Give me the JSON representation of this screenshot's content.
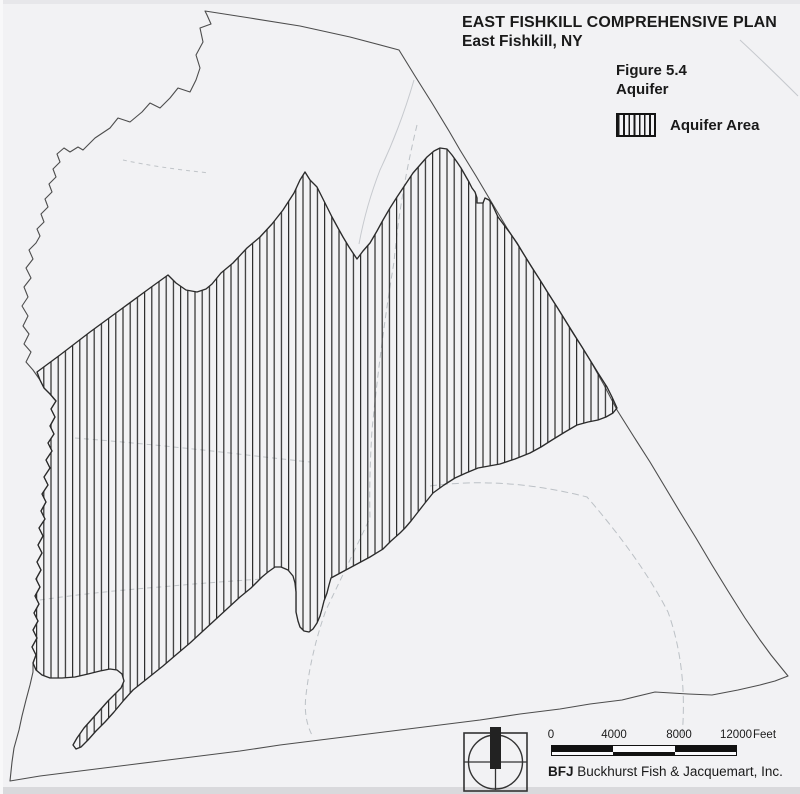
{
  "header": {
    "title": "EAST FISHKILL COMPREHENSIVE PLAN",
    "subtitle": "East Fishkill, NY",
    "figure_label": "Figure 5.4",
    "figure_title": "Aquifer"
  },
  "legend": {
    "items": [
      {
        "label": "Aquifer Area",
        "swatch": "vertical-hatch"
      }
    ]
  },
  "scale_bar": {
    "tick_labels": [
      "0",
      "4000",
      "8000",
      "12000"
    ],
    "unit_label": "Feet"
  },
  "attribution": {
    "firm_abbreviation": "BFJ",
    "firm_name": "Buckhurst Fish & Jacquemart, Inc."
  },
  "icons": {
    "north_indicator": "compass-north-arrow"
  },
  "colors": {
    "paper": "#f2f2f4",
    "ink": "#1a1a1a",
    "boundary_line": "#4d4d4d",
    "aquifer_outline": "#2b2b2b",
    "hatch_line": "#2b2b2b",
    "pencil_line": "#b3b8bd"
  },
  "map": {
    "hatch_spacing_px": 7.2,
    "town_boundary_points": [
      [
        205,
        11
      ],
      [
        250,
        18
      ],
      [
        300,
        26
      ],
      [
        350,
        37
      ],
      [
        399,
        50
      ],
      [
        415,
        76
      ],
      [
        432,
        103
      ],
      [
        449,
        131
      ],
      [
        460,
        150
      ],
      [
        476,
        176
      ],
      [
        492,
        203
      ],
      [
        507,
        228
      ],
      [
        523,
        253
      ],
      [
        540,
        280
      ],
      [
        557,
        307
      ],
      [
        574,
        334
      ],
      [
        590,
        360
      ],
      [
        604,
        385
      ],
      [
        617,
        410
      ],
      [
        634,
        437
      ],
      [
        650,
        462
      ],
      [
        665,
        487
      ],
      [
        680,
        512
      ],
      [
        696,
        538
      ],
      [
        712,
        565
      ],
      [
        728,
        591
      ],
      [
        745,
        618
      ],
      [
        760,
        640
      ],
      [
        771,
        655
      ],
      [
        788,
        676
      ],
      [
        775,
        681
      ],
      [
        760,
        685
      ],
      [
        738,
        690
      ],
      [
        712,
        695
      ],
      [
        688,
        694
      ],
      [
        655,
        692
      ],
      [
        622,
        700
      ],
      [
        590,
        704
      ],
      [
        560,
        709
      ],
      [
        520,
        714
      ],
      [
        480,
        720
      ],
      [
        440,
        725
      ],
      [
        400,
        730
      ],
      [
        360,
        735
      ],
      [
        320,
        740
      ],
      [
        280,
        745
      ],
      [
        240,
        751
      ],
      [
        200,
        756
      ],
      [
        160,
        761
      ],
      [
        120,
        766
      ],
      [
        80,
        771
      ],
      [
        40,
        776
      ],
      [
        10,
        781
      ],
      [
        12,
        762
      ],
      [
        14,
        748
      ],
      [
        19,
        730
      ],
      [
        22,
        716
      ],
      [
        26,
        700
      ],
      [
        30,
        685
      ],
      [
        33,
        672
      ],
      [
        33,
        663
      ],
      [
        36,
        655
      ],
      [
        32,
        647
      ],
      [
        37,
        638
      ],
      [
        33,
        630
      ],
      [
        38,
        621
      ],
      [
        34,
        613
      ],
      [
        39,
        604
      ],
      [
        35,
        596
      ],
      [
        40,
        587
      ],
      [
        36,
        579
      ],
      [
        41,
        570
      ],
      [
        37,
        562
      ],
      [
        42,
        553
      ],
      [
        38,
        545
      ],
      [
        43,
        536
      ],
      [
        39,
        528
      ],
      [
        45,
        519
      ],
      [
        41,
        511
      ],
      [
        46,
        502
      ],
      [
        42,
        494
      ],
      [
        48,
        485
      ],
      [
        44,
        477
      ],
      [
        50,
        468
      ],
      [
        46,
        460
      ],
      [
        52,
        451
      ],
      [
        48,
        443
      ],
      [
        54,
        434
      ],
      [
        50,
        426
      ],
      [
        55,
        417
      ],
      [
        51,
        409
      ],
      [
        56,
        401
      ],
      [
        50,
        394
      ],
      [
        44,
        388
      ],
      [
        40,
        380
      ],
      [
        33,
        370
      ],
      [
        26,
        362
      ],
      [
        31,
        352
      ],
      [
        24,
        344
      ],
      [
        29,
        334
      ],
      [
        23,
        326
      ],
      [
        28,
        316
      ],
      [
        22,
        306
      ],
      [
        28,
        297
      ],
      [
        24,
        287
      ],
      [
        31,
        278
      ],
      [
        26,
        268
      ],
      [
        33,
        259
      ],
      [
        29,
        250
      ],
      [
        36,
        243
      ],
      [
        40,
        236
      ],
      [
        37,
        229
      ],
      [
        44,
        222
      ],
      [
        41,
        214
      ],
      [
        48,
        207
      ],
      [
        45,
        199
      ],
      [
        52,
        192
      ],
      [
        49,
        184
      ],
      [
        56,
        177
      ],
      [
        53,
        169
      ],
      [
        60,
        162
      ],
      [
        57,
        154
      ],
      [
        64,
        148
      ],
      [
        70,
        152
      ],
      [
        78,
        147
      ],
      [
        83,
        150
      ],
      [
        95,
        138
      ],
      [
        110,
        128
      ],
      [
        118,
        118
      ],
      [
        130,
        122
      ],
      [
        142,
        112
      ],
      [
        150,
        103
      ],
      [
        160,
        108
      ],
      [
        170,
        98
      ],
      [
        178,
        88
      ],
      [
        190,
        92
      ],
      [
        196,
        80
      ],
      [
        200,
        68
      ],
      [
        196,
        55
      ],
      [
        203,
        42
      ],
      [
        200,
        28
      ],
      [
        211,
        24
      ],
      [
        207,
        15
      ]
    ],
    "aquifer_area_points": [
      [
        37,
        372
      ],
      [
        60,
        355
      ],
      [
        90,
        332
      ],
      [
        120,
        310
      ],
      [
        150,
        288
      ],
      [
        168,
        275
      ],
      [
        176,
        283
      ],
      [
        186,
        290
      ],
      [
        197,
        292
      ],
      [
        206,
        289
      ],
      [
        212,
        284
      ],
      [
        221,
        273
      ],
      [
        233,
        263
      ],
      [
        247,
        248
      ],
      [
        260,
        237
      ],
      [
        272,
        224
      ],
      [
        283,
        210
      ],
      [
        294,
        193
      ],
      [
        300,
        180
      ],
      [
        305,
        172
      ],
      [
        310,
        180
      ],
      [
        317,
        187
      ],
      [
        325,
        203
      ],
      [
        332,
        217
      ],
      [
        338,
        228
      ],
      [
        343,
        237
      ],
      [
        349,
        247
      ],
      [
        353,
        253
      ],
      [
        357,
        259
      ],
      [
        363,
        251
      ],
      [
        370,
        243
      ],
      [
        377,
        231
      ],
      [
        383,
        220
      ],
      [
        390,
        208
      ],
      [
        397,
        197
      ],
      [
        405,
        185
      ],
      [
        413,
        173
      ],
      [
        420,
        165
      ],
      [
        427,
        157
      ],
      [
        434,
        151
      ],
      [
        440,
        148
      ],
      [
        447,
        149
      ],
      [
        452,
        155
      ],
      [
        457,
        162
      ],
      [
        461,
        168
      ],
      [
        465,
        175
      ],
      [
        469,
        182
      ],
      [
        472,
        188
      ],
      [
        475,
        192
      ],
      [
        477,
        198
      ],
      [
        477,
        203
      ],
      [
        483,
        203
      ],
      [
        485,
        198
      ],
      [
        489,
        200
      ],
      [
        492,
        204
      ],
      [
        498,
        217
      ],
      [
        504,
        225
      ],
      [
        510,
        233
      ],
      [
        517,
        243
      ],
      [
        523,
        253
      ],
      [
        531,
        266
      ],
      [
        540,
        280
      ],
      [
        548,
        293
      ],
      [
        557,
        307
      ],
      [
        565,
        320
      ],
      [
        573,
        333
      ],
      [
        582,
        347
      ],
      [
        590,
        360
      ],
      [
        598,
        373
      ],
      [
        607,
        387
      ],
      [
        612,
        397
      ],
      [
        617,
        408
      ],
      [
        613,
        413
      ],
      [
        606,
        417
      ],
      [
        598,
        420
      ],
      [
        588,
        422
      ],
      [
        577,
        425
      ],
      [
        565,
        432
      ],
      [
        552,
        440
      ],
      [
        541,
        447
      ],
      [
        530,
        453
      ],
      [
        515,
        459
      ],
      [
        500,
        464
      ],
      [
        489,
        466
      ],
      [
        478,
        468
      ],
      [
        466,
        473
      ],
      [
        455,
        478
      ],
      [
        444,
        485
      ],
      [
        433,
        493
      ],
      [
        425,
        503
      ],
      [
        418,
        512
      ],
      [
        411,
        521
      ],
      [
        405,
        528
      ],
      [
        400,
        533
      ],
      [
        391,
        541
      ],
      [
        383,
        549
      ],
      [
        370,
        557
      ],
      [
        357,
        564
      ],
      [
        344,
        571
      ],
      [
        331,
        578
      ],
      [
        329,
        585
      ],
      [
        327,
        593
      ],
      [
        324,
        601
      ],
      [
        322,
        609
      ],
      [
        320,
        616
      ],
      [
        317,
        623
      ],
      [
        313,
        629
      ],
      [
        309,
        632
      ],
      [
        304,
        631
      ],
      [
        300,
        627
      ],
      [
        298,
        621
      ],
      [
        296,
        612
      ],
      [
        296,
        601
      ],
      [
        296,
        592
      ],
      [
        295,
        583
      ],
      [
        293,
        576
      ],
      [
        288,
        570
      ],
      [
        281,
        567
      ],
      [
        275,
        567
      ],
      [
        268,
        572
      ],
      [
        262,
        577
      ],
      [
        251,
        588
      ],
      [
        240,
        597
      ],
      [
        228,
        608
      ],
      [
        215,
        620
      ],
      [
        203,
        631
      ],
      [
        190,
        643
      ],
      [
        177,
        654
      ],
      [
        163,
        666
      ],
      [
        148,
        678
      ],
      [
        133,
        690
      ],
      [
        124,
        700
      ],
      [
        114,
        712
      ],
      [
        105,
        722
      ],
      [
        96,
        731
      ],
      [
        88,
        740
      ],
      [
        81,
        747
      ],
      [
        76,
        749
      ],
      [
        73,
        745
      ],
      [
        77,
        738
      ],
      [
        84,
        728
      ],
      [
        92,
        719
      ],
      [
        100,
        710
      ],
      [
        108,
        701
      ],
      [
        115,
        694
      ],
      [
        121,
        688
      ],
      [
        124,
        681
      ],
      [
        122,
        674
      ],
      [
        117,
        670
      ],
      [
        110,
        669
      ],
      [
        100,
        671
      ],
      [
        88,
        674
      ],
      [
        75,
        677
      ],
      [
        62,
        678
      ],
      [
        50,
        678
      ],
      [
        42,
        675
      ],
      [
        36,
        670
      ],
      [
        33,
        663
      ],
      [
        36,
        655
      ],
      [
        32,
        647
      ],
      [
        37,
        638
      ],
      [
        33,
        630
      ],
      [
        38,
        621
      ],
      [
        34,
        613
      ],
      [
        39,
        604
      ],
      [
        35,
        596
      ],
      [
        40,
        587
      ],
      [
        36,
        579
      ],
      [
        41,
        570
      ],
      [
        37,
        562
      ],
      [
        42,
        553
      ],
      [
        38,
        545
      ],
      [
        43,
        536
      ],
      [
        39,
        528
      ],
      [
        45,
        519
      ],
      [
        41,
        511
      ],
      [
        46,
        502
      ],
      [
        42,
        494
      ],
      [
        48,
        485
      ],
      [
        44,
        477
      ],
      [
        50,
        468
      ],
      [
        46,
        460
      ],
      [
        52,
        451
      ],
      [
        48,
        443
      ],
      [
        54,
        434
      ],
      [
        50,
        426
      ],
      [
        55,
        417
      ],
      [
        51,
        409
      ],
      [
        56,
        401
      ],
      [
        50,
        394
      ],
      [
        44,
        388
      ],
      [
        40,
        380
      ]
    ],
    "pencil_line_paths": [
      {
        "d": "M123,160 Q160,168 210,173",
        "dash": "4 4",
        "o": 0.8
      },
      {
        "d": "M414,80 Q400,128 380,170 Q366,206 359,244",
        "dash": "",
        "o": 0.7
      },
      {
        "d": "M740,40 Q768,66 798,96",
        "dash": "",
        "o": 0.7
      },
      {
        "d": "M417,125 Q400,195 394,262 Q381,340 372,430 Q369,478 370,518 Q349,562 326,610 Q311,652 306,695 Q303,719 313,737",
        "dash": "6 4",
        "o": 0.85
      },
      {
        "d": "M430,486 Q505,476 587,497 Q640,558 668,612 Q688,668 682,737",
        "dash": "7 4",
        "o": 0.85
      },
      {
        "d": "M40,600 Q95,592 160,587 Q215,582 262,579",
        "dash": "5 4",
        "o": 0.8
      },
      {
        "d": "M75,438 Q150,444 230,453 Q272,458 310,462",
        "dash": "5 4",
        "o": 0.8
      }
    ]
  }
}
